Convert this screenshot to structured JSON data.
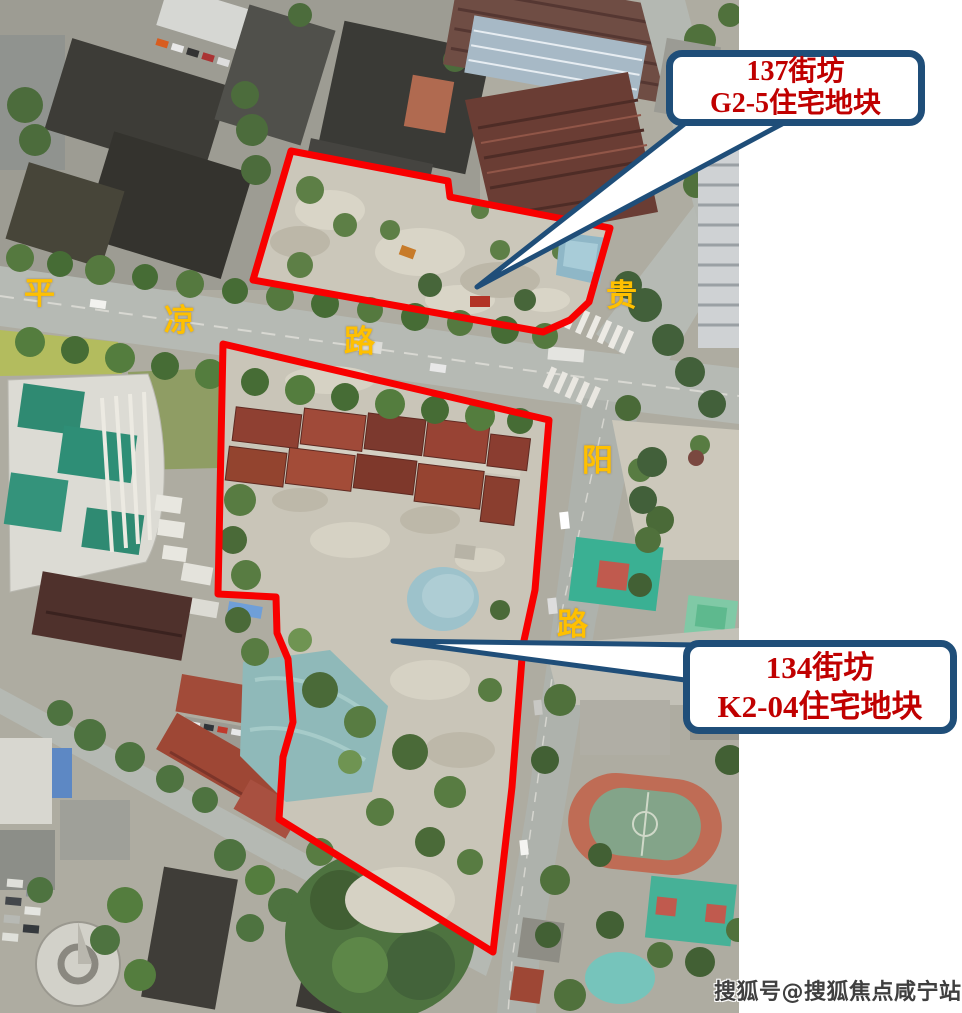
{
  "callouts": [
    {
      "id": "parcel-137",
      "line1": "137街坊",
      "line2": "G2-5住宅地块"
    },
    {
      "id": "parcel-134",
      "line1": "134街坊",
      "line2": "K2-04住宅地块"
    }
  ],
  "road_labels": {
    "pingliang": {
      "name": "平凉路",
      "chars": [
        "平",
        "凉",
        "路"
      ]
    },
    "guiyang": {
      "name": "贵阳路",
      "chars": [
        "贵",
        "阳",
        "路"
      ]
    }
  },
  "watermark": {
    "text": "搜狐号@搜狐焦点咸宁站"
  },
  "colors": {
    "boundary_red": "#F80000",
    "callout_border": "#1F4E79",
    "callout_text": "#C00000",
    "road_label": "#FFC000",
    "watermark_text": "#3F3F3F"
  }
}
